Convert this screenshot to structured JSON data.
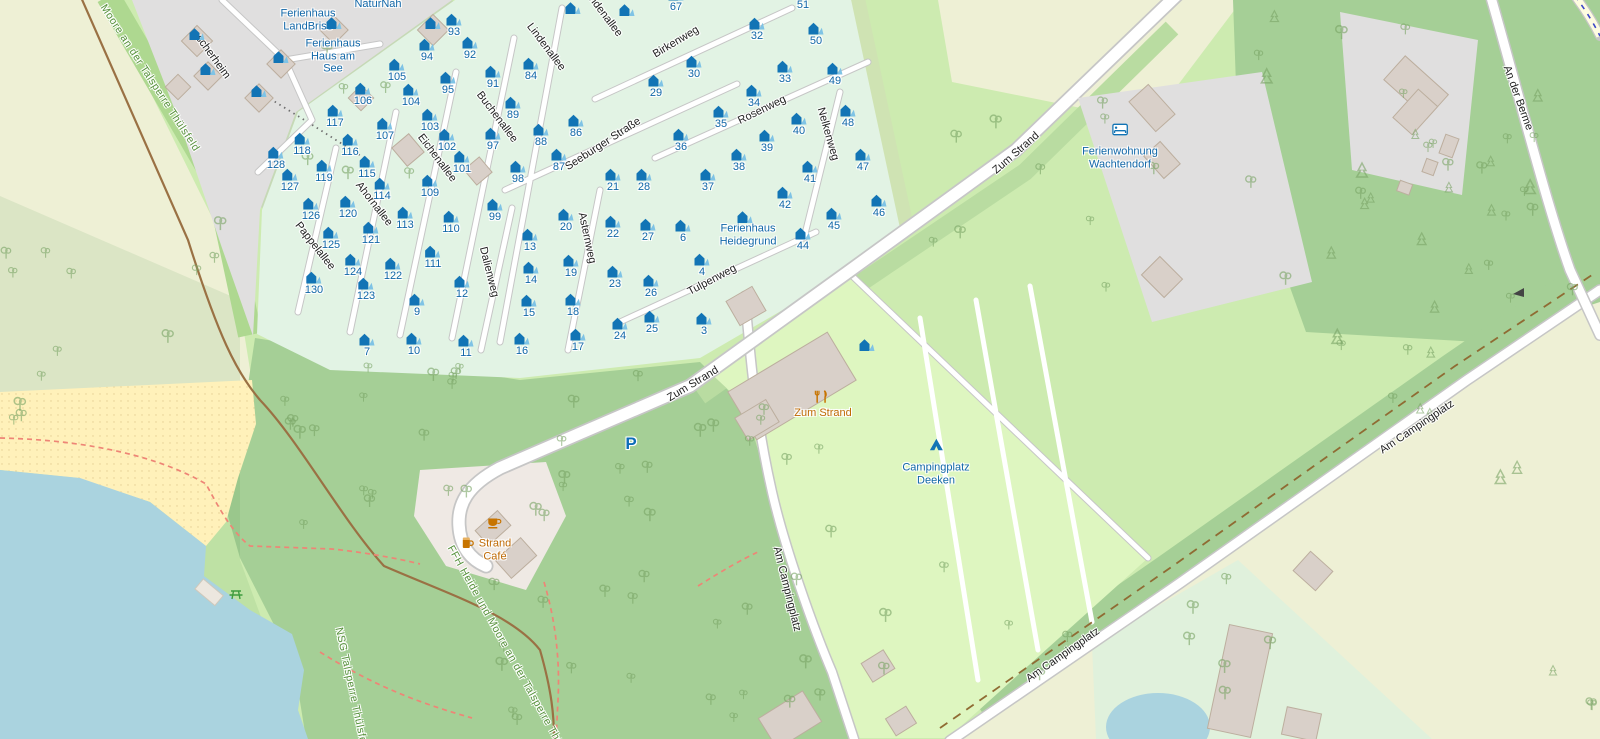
{
  "map": {
    "colors": {
      "water": "#aad3df",
      "beach": "#fff1ba",
      "farmland": "#eef0d5",
      "grass": "#cdebb0",
      "forest": "#a5cf96",
      "chalet_area": "#e2f3e4",
      "campsite": "#def6c0",
      "residential": "#e0dfdf",
      "building": "#d9d0c9",
      "tourism_blue": "#1167a8",
      "amenity_orange": "#bf6a04",
      "protected_green": "#57913c"
    },
    "street_labels": [
      {
        "t": "scherheim",
        "x": 213,
        "y": 57,
        "r": 54
      },
      {
        "t": "Lindenallee",
        "x": 546,
        "y": 47,
        "r": 53
      },
      {
        "t": "Lindenallee",
        "x": 603,
        "y": 13,
        "r": 53
      },
      {
        "t": "Buchenallee",
        "x": 497,
        "y": 117,
        "r": 53
      },
      {
        "t": "Eichenallee",
        "x": 437,
        "y": 158,
        "r": 53
      },
      {
        "t": "Ahornallee",
        "x": 374,
        "y": 204,
        "r": 52
      },
      {
        "t": "Pappelallee",
        "x": 315,
        "y": 246,
        "r": 52
      },
      {
        "t": "Dalienweg",
        "x": 489,
        "y": 272,
        "r": 76
      },
      {
        "t": "Asternweg",
        "x": 587,
        "y": 238,
        "r": 78
      },
      {
        "t": "Birkenweg",
        "x": 676,
        "y": 42,
        "r": -31
      },
      {
        "t": "Seeburger Straße",
        "x": 603,
        "y": 144,
        "r": -33
      },
      {
        "t": "Rosenweg",
        "x": 762,
        "y": 110,
        "r": -26
      },
      {
        "t": "Nelkenweg",
        "x": 828,
        "y": 134,
        "r": 74
      },
      {
        "t": "Tulpenweg",
        "x": 712,
        "y": 280,
        "r": -28
      },
      {
        "t": "Zum Strand",
        "x": 1016,
        "y": 153,
        "r": -41
      },
      {
        "t": "Zum Strand",
        "x": 693,
        "y": 384,
        "r": -31
      },
      {
        "t": "Am Campingplatz",
        "x": 787,
        "y": 589,
        "r": 76
      },
      {
        "t": "Am Campingplatz",
        "x": 1063,
        "y": 655,
        "r": -35
      },
      {
        "t": "Am Campingplatz",
        "x": 1417,
        "y": 427,
        "r": -34
      },
      {
        "t": "An der Berme",
        "x": 1518,
        "y": 98,
        "r": 70
      },
      {
        "t": "Moore an der Talsperre Thülsfeld",
        "x": 150,
        "y": 78,
        "r": 57,
        "cls": "green"
      },
      {
        "t": "FFH Heide und Moore an der Talsperre Thülsfeld",
        "x": 512,
        "y": 658,
        "r": 61,
        "cls": "green"
      },
      {
        "t": "NSG Talsperre Thülsfeld",
        "x": 352,
        "y": 690,
        "r": 78,
        "cls": "green"
      }
    ],
    "poi_labels": [
      {
        "name": "naturnah",
        "lines": [
          "NaturNah"
        ],
        "x": 378,
        "y": 4,
        "type": "tourism"
      },
      {
        "name": "ferienhaus-landbrise",
        "lines": [
          "Ferienhaus",
          "LandBrise"
        ],
        "x": 308,
        "y": 20,
        "type": "tourism"
      },
      {
        "name": "ferienhaus-haus-am-see",
        "lines": [
          "Ferienhaus",
          "Haus am",
          "See"
        ],
        "x": 333,
        "y": 56,
        "type": "tourism"
      },
      {
        "name": "ferienwohnung-wachtendorf",
        "lines": [
          "Ferienwohnung",
          "Wachtendorf"
        ],
        "x": 1120,
        "y": 158,
        "type": "tourism",
        "icon": "bed",
        "icon_dy": -22
      },
      {
        "name": "ferienhaus-heidegrund",
        "lines": [
          "Ferienhaus",
          "Heidegrund"
        ],
        "x": 748,
        "y": 235,
        "type": "tourism"
      },
      {
        "name": "campingplatz-deeken",
        "lines": [
          "Campingplatz",
          "Deeken"
        ],
        "x": 936,
        "y": 474,
        "type": "tourism",
        "icon": "tent",
        "icon_dy": -23
      },
      {
        "name": "zum-strand-restaurant",
        "lines": [
          "Zum Strand"
        ],
        "x": 823,
        "y": 413,
        "type": "amenity",
        "icon": "restaurant",
        "icon_dx": -2,
        "icon_dy": -16
      },
      {
        "name": "strand-cafe",
        "lines": [
          "Strand",
          "Café"
        ],
        "x": 495,
        "y": 550,
        "type": "amenity",
        "icon": "cafe",
        "icon_dy": -21,
        "icon2": "beer",
        "icon2_dx": -27,
        "icon2_dy": -1
      },
      {
        "name": "parking",
        "lines": [
          "P"
        ],
        "x": 631,
        "y": 444,
        "type": "parking"
      },
      {
        "name": "picnic-site",
        "lines": [],
        "x": 236,
        "y": 588,
        "type": "leisure",
        "icon": "picnic",
        "icon_dy": 0
      }
    ],
    "chalets": [
      [
        93,
        454,
        32
      ],
      [
        94,
        427,
        57
      ],
      [
        92,
        470,
        55
      ],
      [
        105,
        397,
        77
      ],
      [
        95,
        448,
        90
      ],
      [
        91,
        493,
        84
      ],
      [
        84,
        531,
        76
      ],
      [
        67,
        676,
        7
      ],
      [
        51,
        803,
        5
      ],
      [
        32,
        757,
        36
      ],
      [
        50,
        816,
        41
      ],
      [
        30,
        694,
        74
      ],
      [
        29,
        656,
        93
      ],
      [
        33,
        785,
        79
      ],
      [
        49,
        835,
        81
      ],
      [
        106,
        363,
        101
      ],
      [
        104,
        411,
        102
      ],
      [
        103,
        430,
        127
      ],
      [
        89,
        513,
        115
      ],
      [
        86,
        576,
        133
      ],
      [
        34,
        754,
        103
      ],
      [
        35,
        721,
        124
      ],
      [
        40,
        799,
        131
      ],
      [
        48,
        848,
        123
      ],
      [
        117,
        335,
        123
      ],
      [
        107,
        385,
        136
      ],
      [
        102,
        447,
        147
      ],
      [
        97,
        493,
        146
      ],
      [
        88,
        541,
        142
      ],
      [
        118,
        302,
        151
      ],
      [
        116,
        350,
        152
      ],
      [
        36,
        681,
        147
      ],
      [
        39,
        767,
        148
      ],
      [
        128,
        276,
        165
      ],
      [
        127,
        290,
        187
      ],
      [
        119,
        324,
        178
      ],
      [
        115,
        367,
        174
      ],
      [
        101,
        462,
        169
      ],
      [
        87,
        559,
        167
      ],
      [
        98,
        518,
        179
      ],
      [
        21,
        613,
        187
      ],
      [
        28,
        644,
        187
      ],
      [
        37,
        708,
        187
      ],
      [
        38,
        739,
        167
      ],
      [
        41,
        810,
        179
      ],
      [
        47,
        863,
        167
      ],
      [
        114,
        382,
        196
      ],
      [
        109,
        430,
        193
      ],
      [
        42,
        785,
        205
      ],
      [
        46,
        879,
        213
      ],
      [
        126,
        311,
        216
      ],
      [
        120,
        348,
        214
      ],
      [
        99,
        495,
        217
      ],
      [
        110,
        451,
        229
      ],
      [
        20,
        566,
        227
      ],
      [
        45,
        834,
        226
      ],
      [
        44,
        803,
        246
      ],
      [
        113,
        405,
        225
      ],
      [
        22,
        613,
        234
      ],
      [
        27,
        648,
        237
      ],
      [
        6,
        683,
        238
      ],
      [
        121,
        371,
        240
      ],
      [
        125,
        331,
        245
      ],
      [
        13,
        530,
        247
      ],
      [
        19,
        571,
        273
      ],
      [
        23,
        615,
        284
      ],
      [
        26,
        651,
        293
      ],
      [
        4,
        702,
        272
      ],
      [
        111,
        433,
        264
      ],
      [
        124,
        353,
        272
      ],
      [
        122,
        393,
        276
      ],
      [
        12,
        462,
        294
      ],
      [
        14,
        531,
        280
      ],
      [
        15,
        529,
        313
      ],
      [
        18,
        573,
        312
      ],
      [
        24,
        620,
        336
      ],
      [
        25,
        652,
        329
      ],
      [
        3,
        704,
        331
      ],
      [
        130,
        314,
        290
      ],
      [
        123,
        366,
        296
      ],
      [
        9,
        417,
        312
      ],
      [
        7,
        367,
        352
      ],
      [
        10,
        414,
        351
      ],
      [
        11,
        466,
        353
      ],
      [
        16,
        522,
        351
      ],
      [
        17,
        578,
        347
      ]
    ],
    "house_icons": [
      [
        197,
        34
      ],
      [
        208,
        69
      ],
      [
        259,
        91
      ],
      [
        281,
        57
      ],
      [
        334,
        23
      ],
      [
        433,
        23
      ],
      [
        745,
        217
      ],
      [
        867,
        345
      ],
      [
        573,
        8
      ],
      [
        627,
        10
      ]
    ]
  }
}
